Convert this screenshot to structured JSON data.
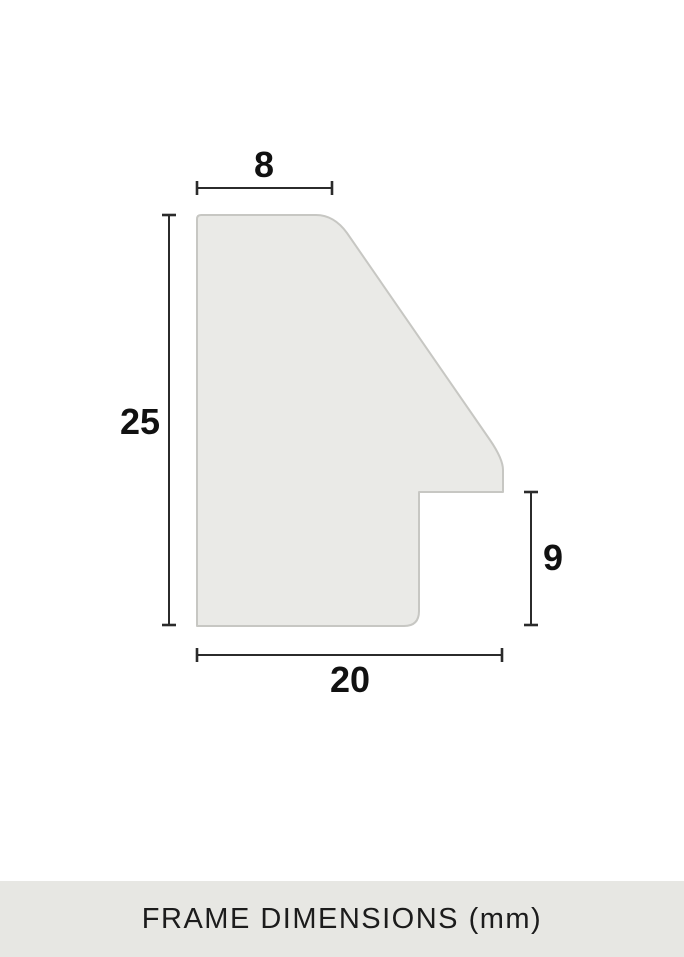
{
  "diagram": {
    "measurements": {
      "top_width": "8",
      "overall_height": "25",
      "rabbet_height": "9",
      "overall_width": "20"
    }
  },
  "caption_bar": {
    "label": "FRAME DIMENSIONS (mm)"
  },
  "colors": {
    "background": "#ffffff",
    "shape_fill": "#eaeae7",
    "shape_outline": "#c7c7c3",
    "dimension_line": "#2b2b2b",
    "label_text": "#111111",
    "caption_bar_bg": "#e7e7e3",
    "caption_text": "#1c1c1c"
  }
}
